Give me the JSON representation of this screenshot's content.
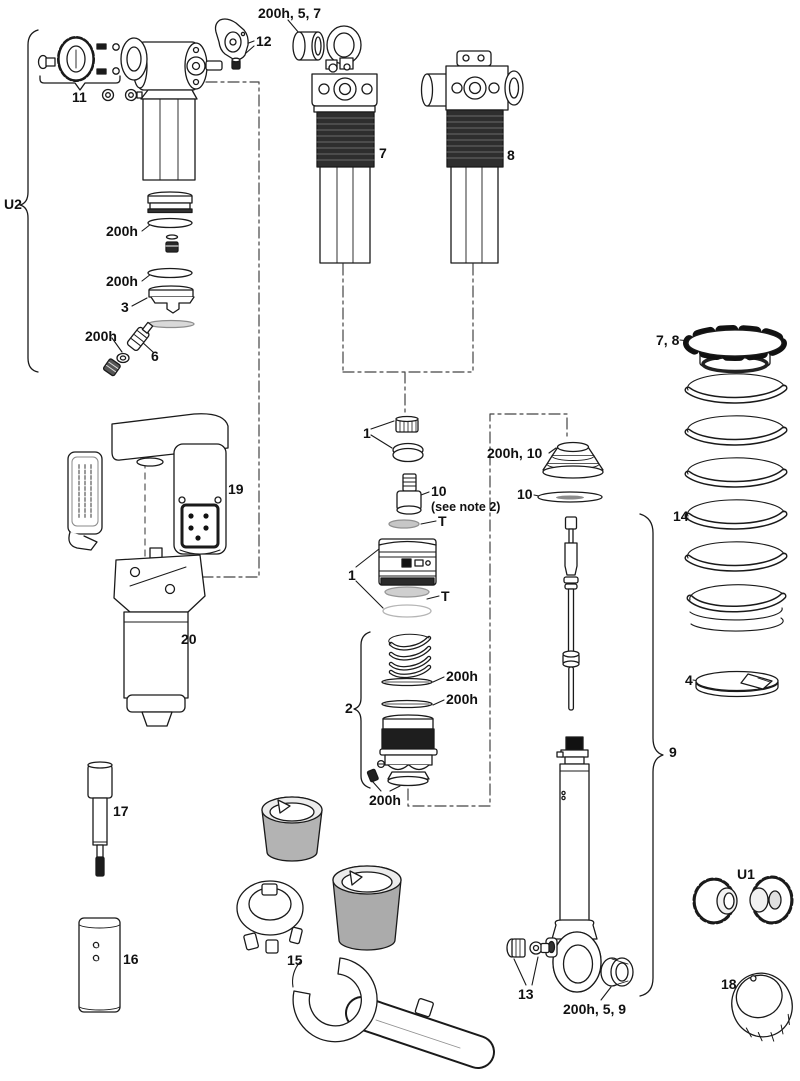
{
  "diagram": {
    "type": "exploded-parts-diagram",
    "labels": {
      "bushing_top": "200h, 5, 7",
      "part12": "12",
      "part11": "11",
      "u2": "U2",
      "part7": "7",
      "part8": "8",
      "oring_top1": "200h",
      "oring_top2": "200h",
      "part3": "3",
      "oring_valve": "200h",
      "part6": "6",
      "preload_7_8": "7, 8",
      "part1_upper": "1",
      "part10": "10",
      "see_note": "(see note 2)",
      "t_upper": "T",
      "part1_lower": "1",
      "t_lower": "T",
      "bellows_200h_10": "200h, 10",
      "disc_10": "10",
      "part14": "14",
      "part4": "4",
      "part2": "2",
      "oring_mid1": "200h",
      "oring_mid2": "200h",
      "screw_200h": "200h",
      "part19": "19",
      "part20": "20",
      "part17": "17",
      "part16": "16",
      "part15": "15",
      "part9": "9",
      "part13": "13",
      "bushing_bottom": "200h, 5, 9",
      "u1": "U1",
      "part18": "18"
    }
  }
}
